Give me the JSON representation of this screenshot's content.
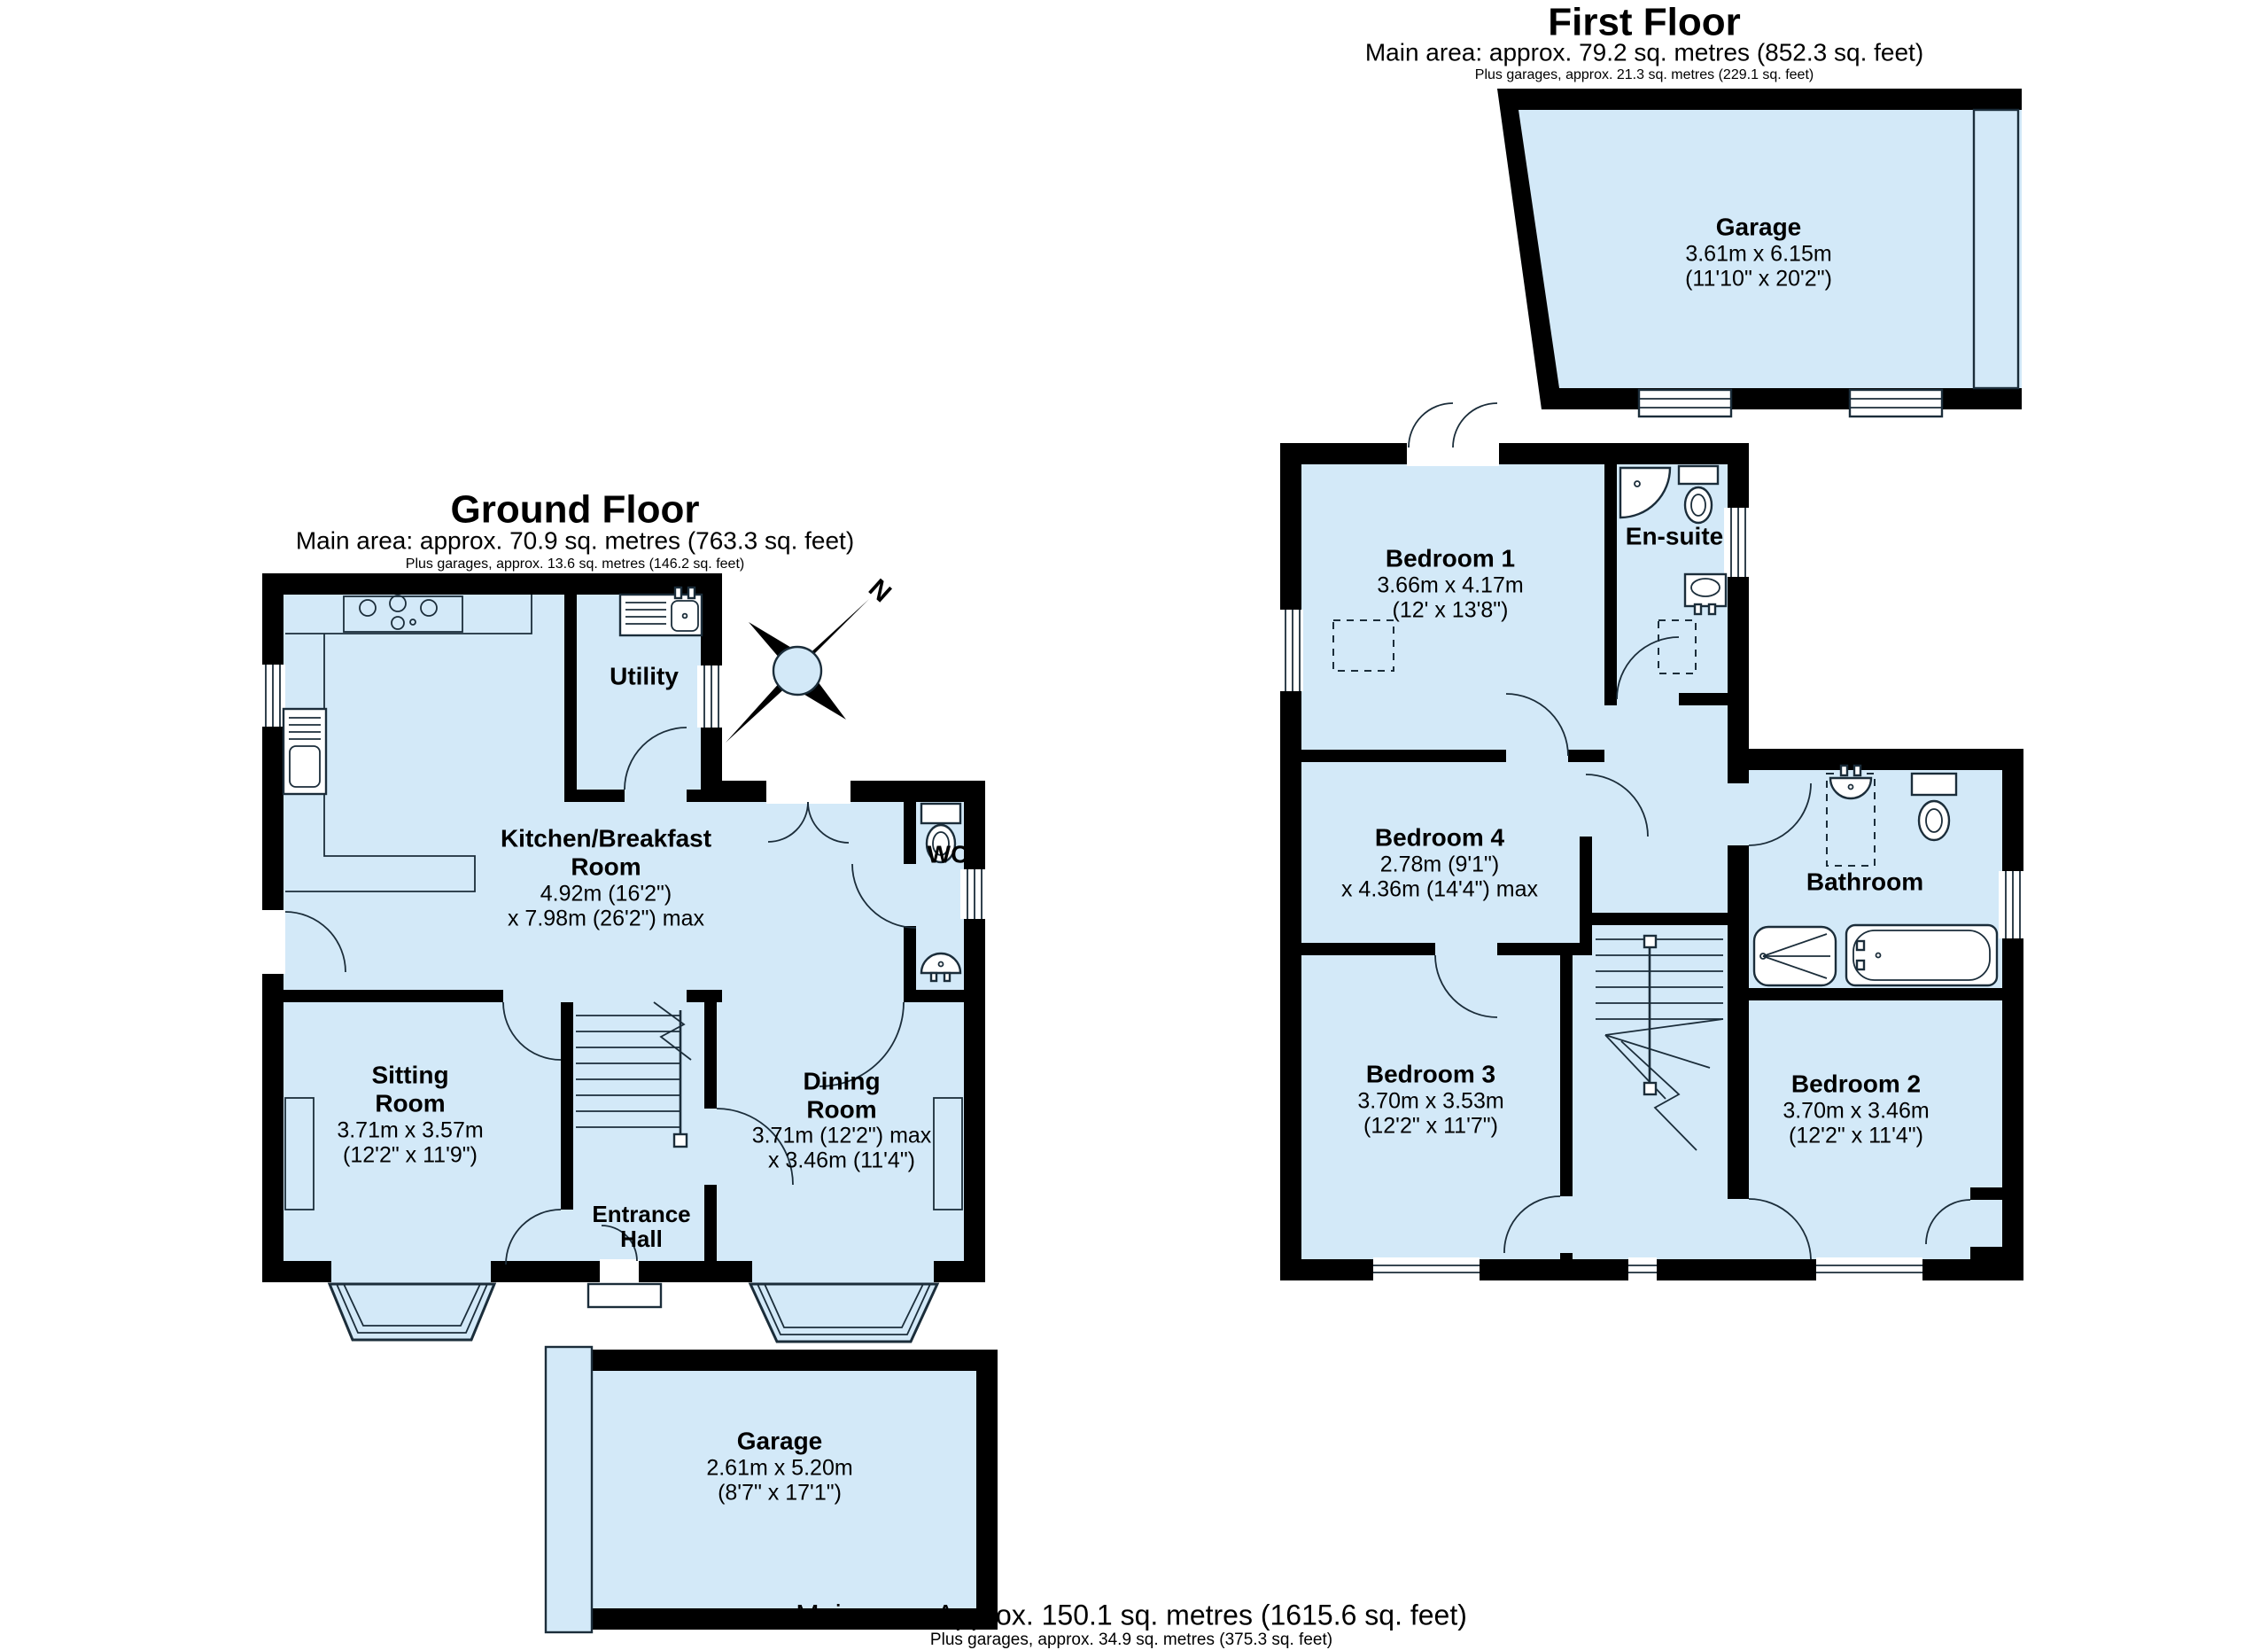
{
  "colors": {
    "room_fill": "#d3e9f8",
    "wall": "#000000",
    "line": "#1b2d3a",
    "background": "#ffffff"
  },
  "compass": {
    "label": "N"
  },
  "ground_floor": {
    "title": "Ground Floor",
    "area_line": "Main area: approx. 70.9 sq. metres (763.3 sq. feet)",
    "garage_line": "Plus garages, approx. 13.6 sq. metres (146.2 sq. feet)",
    "rooms": {
      "kitchen": {
        "name_line1": "Kitchen/Breakfast",
        "name_line2": "Room",
        "dim1": "4.92m (16'2\")",
        "dim2": "x 7.98m (26'2\") max"
      },
      "utility": {
        "name": "Utility"
      },
      "wc": {
        "name": "WC"
      },
      "sitting": {
        "name_line1": "Sitting",
        "name_line2": "Room",
        "dim1": "3.71m x 3.57m",
        "dim2": "(12'2\" x 11'9\")"
      },
      "entrance": {
        "name_line1": "Entrance",
        "name_line2": "Hall"
      },
      "dining": {
        "name_line1": "Dining",
        "name_line2": "Room",
        "dim1": "3.71m (12'2\") max",
        "dim2": "x 3.46m (11'4\")"
      },
      "garage": {
        "name": "Garage",
        "dim1": "2.61m x 5.20m",
        "dim2": "(8'7\" x 17'1\")"
      }
    }
  },
  "first_floor": {
    "title": "First Floor",
    "area_line": "Main area: approx. 79.2 sq. metres (852.3 sq. feet)",
    "garage_line": "Plus garages, approx. 21.3 sq. metres (229.1 sq. feet)",
    "rooms": {
      "garage": {
        "name": "Garage",
        "dim1": "3.61m x 6.15m",
        "dim2": "(11'10\" x 20'2\")"
      },
      "bedroom1": {
        "name": "Bedroom 1",
        "dim1": "3.66m x 4.17m",
        "dim2": "(12' x 13'8\")"
      },
      "ensuite": {
        "name": "En-suite"
      },
      "bedroom4": {
        "name": "Bedroom 4",
        "dim1": "2.78m (9'1\")",
        "dim2": "x 4.36m (14'4\") max"
      },
      "bathroom": {
        "name": "Bathroom"
      },
      "bedroom3": {
        "name": "Bedroom 3",
        "dim1": "3.70m x 3.53m",
        "dim2": "(12'2\" x 11'7\")"
      },
      "bedroom2": {
        "name": "Bedroom 2",
        "dim1": "3.70m x 3.46m",
        "dim2": "(12'2\" x 11'4\")"
      }
    }
  },
  "footer": {
    "area_line": "Main area: Approx. 150.1 sq. metres (1615.6 sq. feet)",
    "garage_line": "Plus garages, approx. 34.9 sq. metres (375.3 sq. feet)"
  }
}
